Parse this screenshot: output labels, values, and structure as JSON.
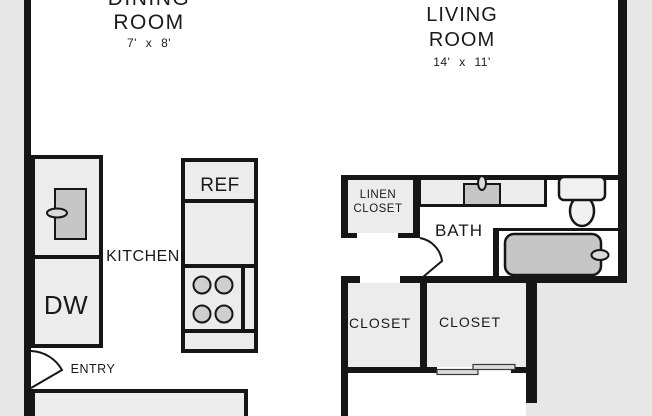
{
  "rooms": {
    "dining": {
      "name_line1": "DINING",
      "name_line2": "ROOM",
      "dimensions": "7' x 8'"
    },
    "living": {
      "name_line1": "LIVING",
      "name_line2": "ROOM",
      "dimensions": "14' x 11'"
    },
    "kitchen": {
      "label": "KITCHEN"
    },
    "bath": {
      "label": "BATH"
    },
    "linen_closet": {
      "name_line1": "LINEN",
      "name_line2": "CLOSET"
    },
    "closet_left": {
      "label": "CLOSET"
    },
    "closet_right": {
      "label": "CLOSET"
    },
    "entry": {
      "label": "ENTRY"
    }
  },
  "appliances": {
    "refrigerator": "REF",
    "dishwasher": "DW"
  },
  "fixtures": [
    "kitchen-sink-icon",
    "kitchen-faucet-icon",
    "stove-burner-icons",
    "vanity-sink-icon",
    "vanity-faucet-icon",
    "toilet-icon",
    "bathtub-icon",
    "tub-drain-icon",
    "entry-door-swing-icon",
    "bath-door-swing-icon",
    "closet-sliding-door-icon"
  ],
  "colors": {
    "wall": "#161616",
    "room_fill": "#ececec",
    "fixture_fill": "#c6c6c6",
    "outside": "#e7e7e7",
    "interior": "#ffffff",
    "text": "#1a1a1a"
  }
}
